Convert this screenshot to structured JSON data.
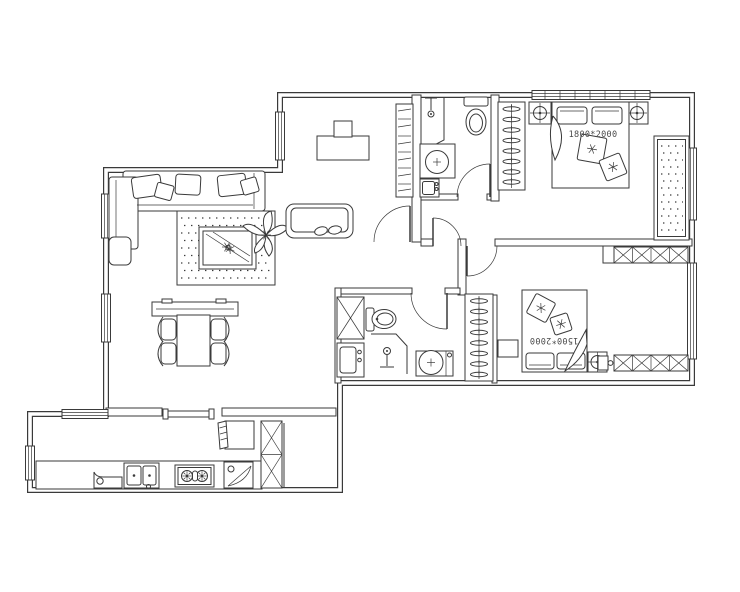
{
  "figure": {
    "type": "apartment-floor-plan",
    "background": "#ffffff",
    "line_color": "#3a3a3a",
    "labels": {
      "master_bed_size": "1800*2000",
      "second_bed_size": "1500*2000"
    },
    "symbols": [
      "wall",
      "window",
      "door-swing",
      "sofa",
      "chaise",
      "cushion",
      "rug",
      "coffee-table",
      "plant",
      "side-table",
      "tv-cabinet",
      "dining-table",
      "dining-chair",
      "desk",
      "monitor",
      "daybed",
      "bookshelf",
      "wardrobe-hangers",
      "double-bed",
      "pillow",
      "nightstand",
      "bedside-lamp",
      "dotted-mat",
      "toilet",
      "shower",
      "washbasin",
      "washing-machine",
      "x-storage-cabinet",
      "refrigerator",
      "kitchen-counter",
      "kitchen-sink",
      "gas-stove",
      "corner-cabinet",
      "pass-through-shelf"
    ]
  }
}
